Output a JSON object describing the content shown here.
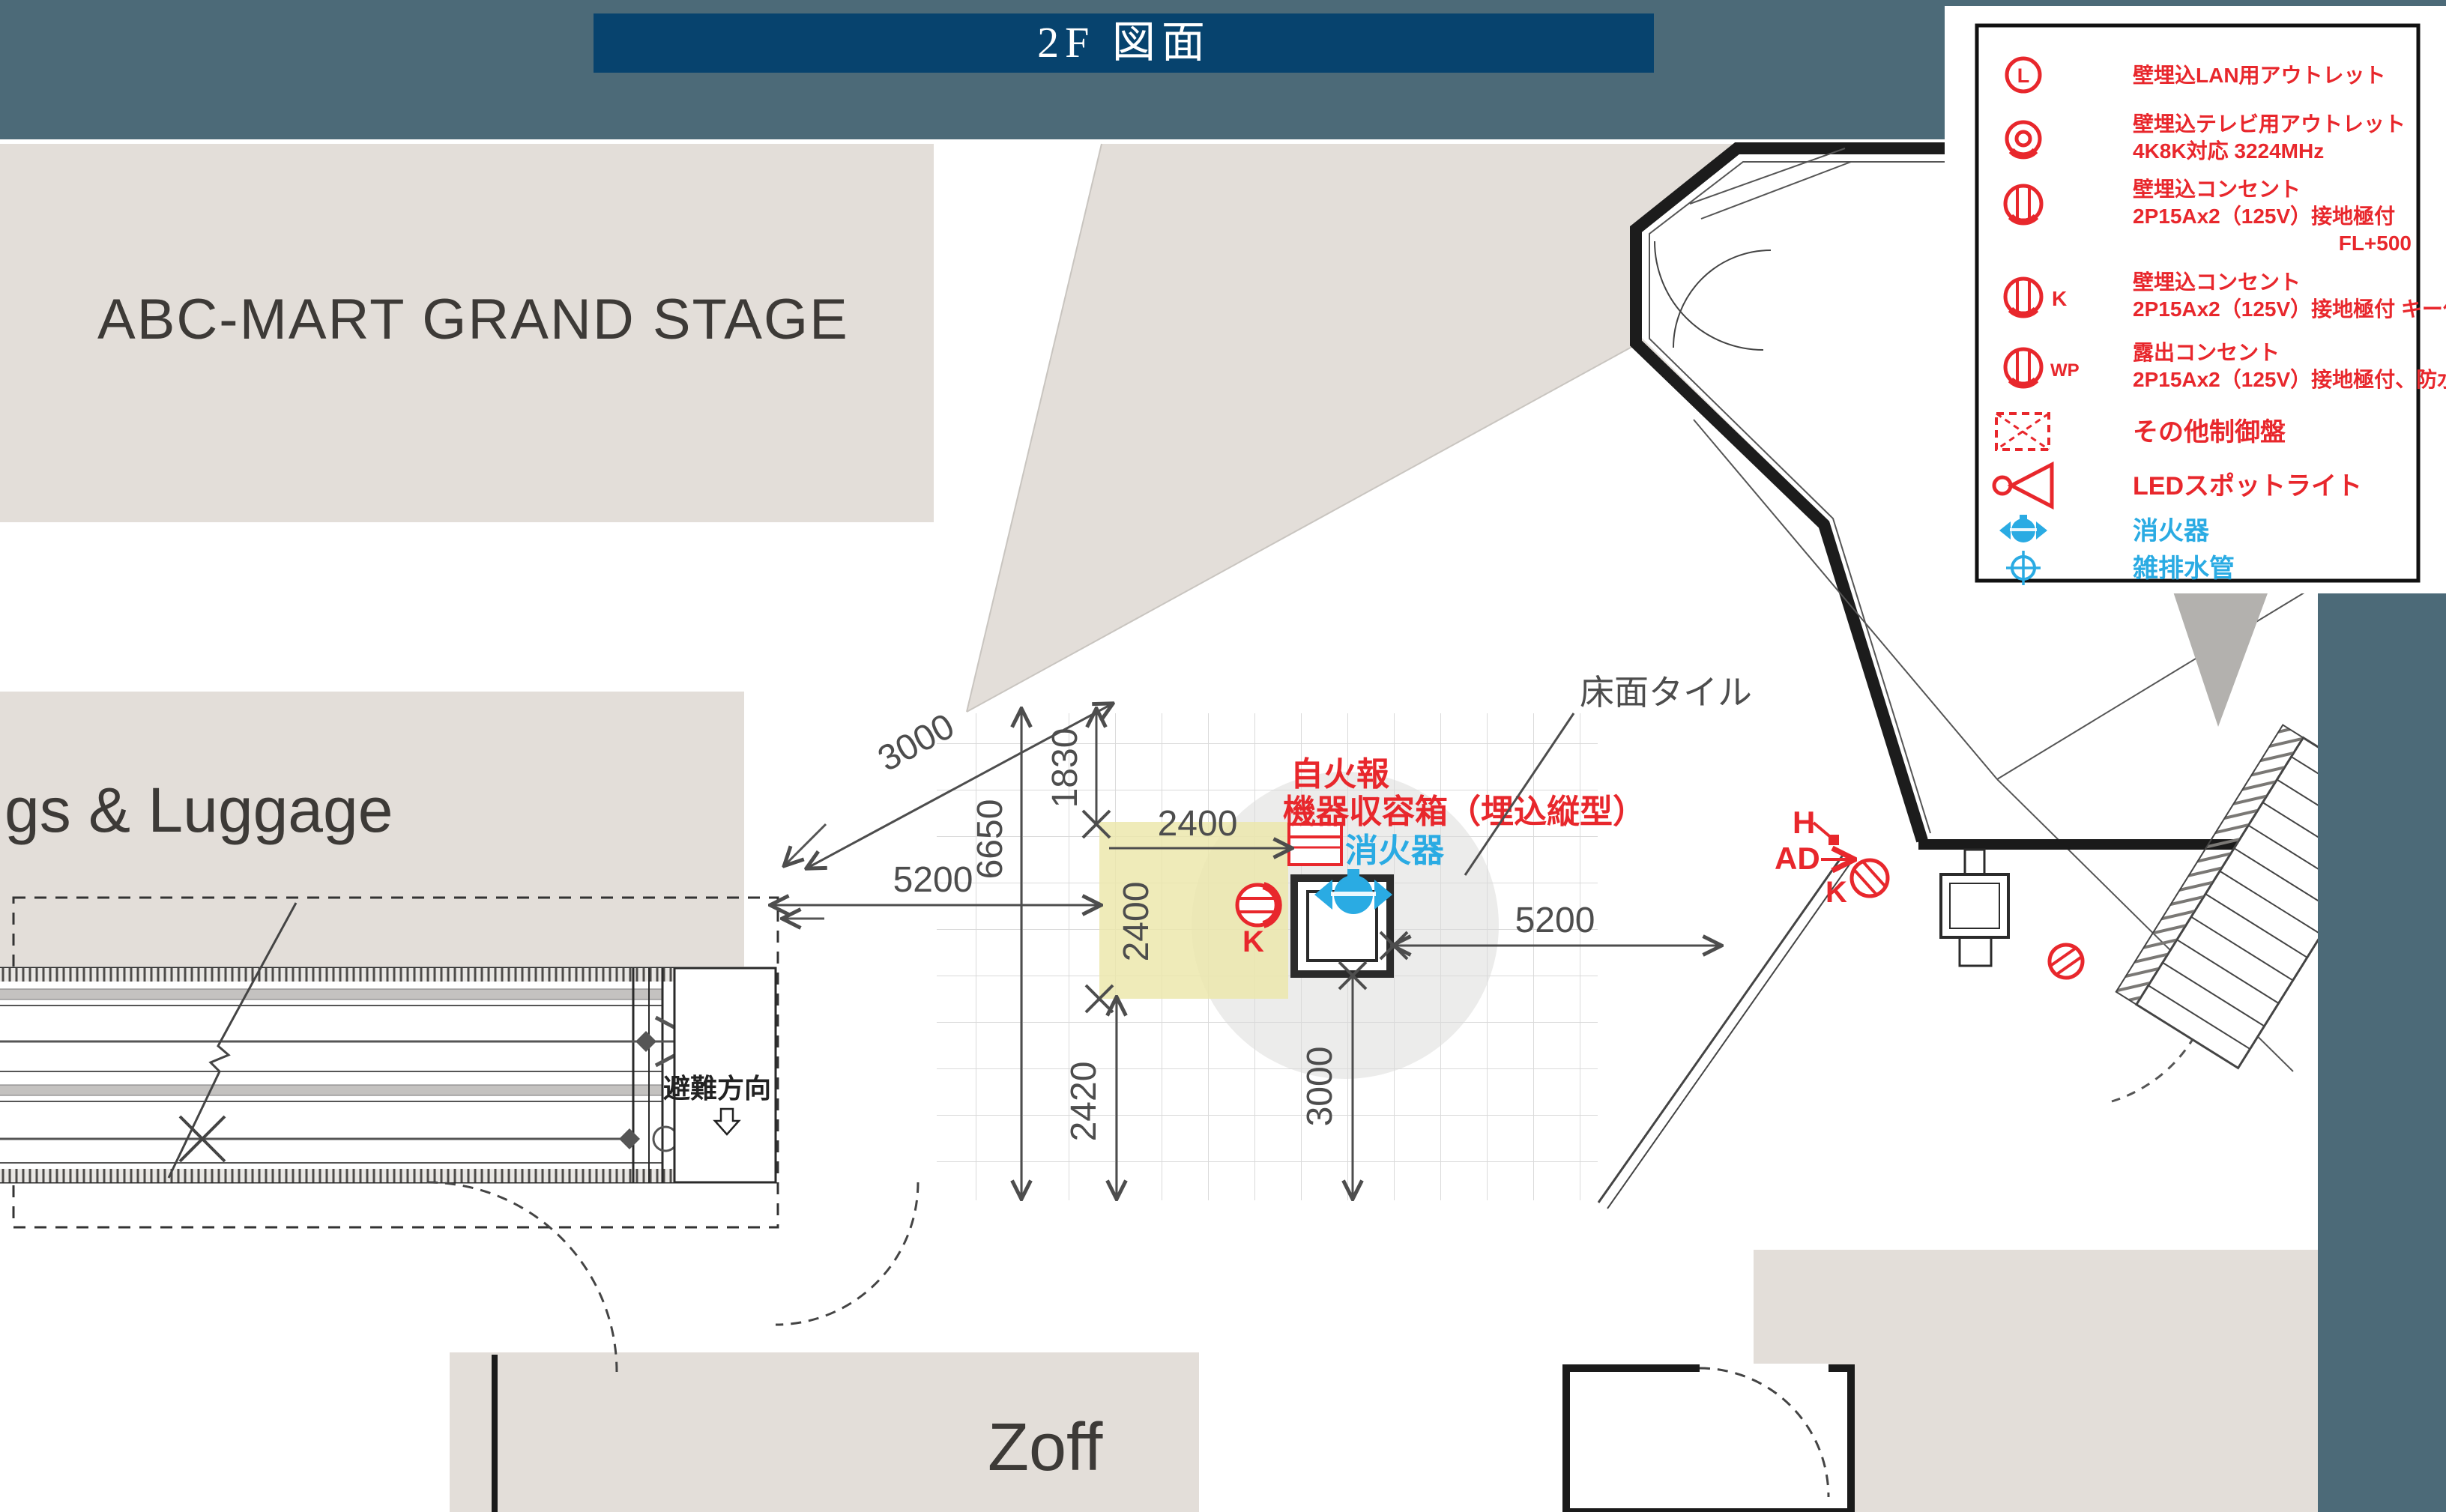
{
  "title_bar": {
    "label": "2F 図面"
  },
  "colors": {
    "page_background": "#4c6a78",
    "title_bar_background": "#07436e",
    "title_text": "#ffffff",
    "plan_white": "#ffffff",
    "plan_beige": "#e3ded9",
    "highlight_yellow": "#ebe6a9",
    "dimension_grey": "#4d4d4d",
    "symbol_red": "#e8272c",
    "symbol_blue": "#2aabe3"
  },
  "stores": {
    "abc_mart": "ABC-MART GRAND STAGE",
    "luggage": "gs & Luggage",
    "zoff": "Zoff"
  },
  "annotations": {
    "floor_tile": "床面タイル",
    "fire_alarm_line1": "自火報",
    "fire_alarm_line2": "機器収容箱（埋込縦型）",
    "extinguisher": "消火器",
    "evacuation": "避難方向",
    "h_label": "H",
    "ad_label": "AD",
    "k_label_column": "K",
    "k_label_right": "K"
  },
  "dimensions": {
    "diag_3000": "3000",
    "v_6650": "6650",
    "v_1830": "1830",
    "h_2400": "2400",
    "v_2400": "2400",
    "h_5200_left": "5200",
    "h_5200_right": "5200",
    "v_2420": "2420",
    "v_3000": "3000"
  },
  "legend": {
    "items": [
      {
        "id": "lan-outlet",
        "symbol": "circle-L",
        "symbol_letter": "L",
        "label_lines": [
          "壁埋込LAN用アウトレット"
        ]
      },
      {
        "id": "tv-outlet",
        "symbol": "double-circle",
        "label_lines": [
          "壁埋込テレビ用アウトレット",
          "4K8K対応 3224MHz"
        ]
      },
      {
        "id": "wall-outlet",
        "symbol": "outlet-circle",
        "label_lines": [
          "壁埋込コンセント",
          "2P15Ax2（125V）接地極付"
        ],
        "note": "FL+500"
      },
      {
        "id": "wall-outlet-key",
        "symbol": "outlet-circle",
        "symbol_suffix": "K",
        "label_lines": [
          "壁埋込コンセント",
          "2P15Ax2（125V）接地極付 キー付"
        ]
      },
      {
        "id": "exposed-outlet-wp",
        "symbol": "outlet-circle",
        "symbol_suffix": "WP",
        "label_lines": [
          "露出コンセント",
          "2P15Ax2（125V）接地極付、防水型"
        ]
      },
      {
        "id": "control-panel",
        "symbol": "dashed-box",
        "label_lines": [
          "その他制御盤"
        ]
      },
      {
        "id": "led-spotlight",
        "symbol": "spotlight",
        "label_lines": [
          "LEDスポットライト"
        ]
      },
      {
        "id": "fire-extinguisher",
        "symbol": "extinguisher",
        "label_lines": [
          "消火器"
        ]
      },
      {
        "id": "drain-pipe",
        "symbol": "crosshair-circle",
        "label_lines": [
          "雑排水管"
        ]
      }
    ]
  }
}
